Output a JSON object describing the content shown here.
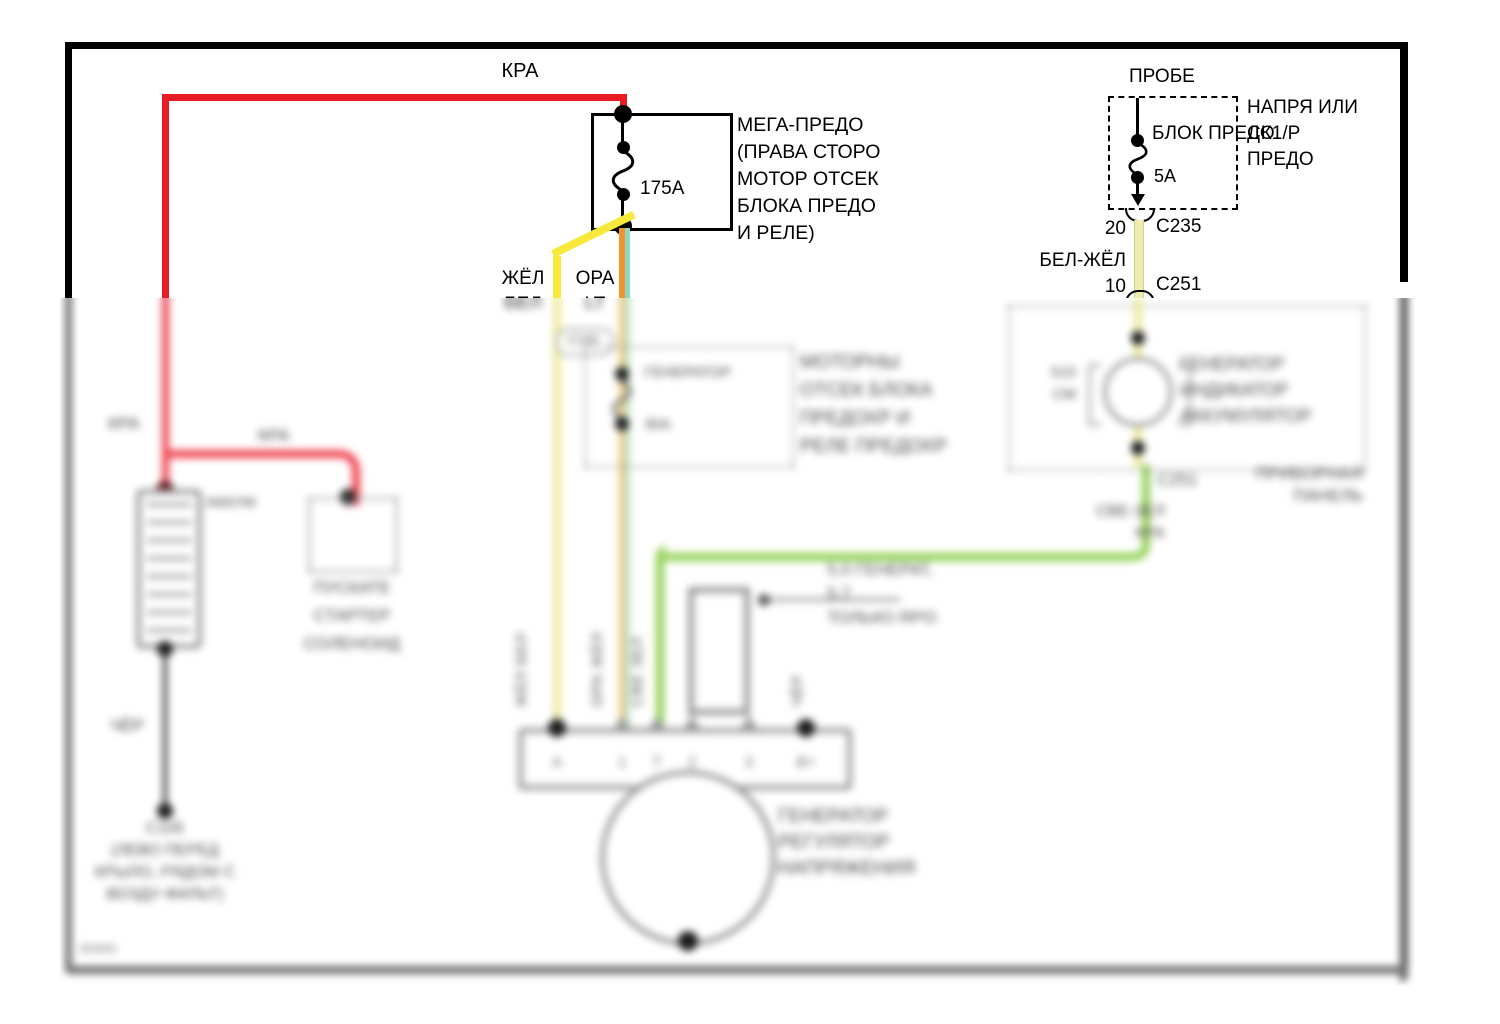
{
  "colors": {
    "wire_red": "#e81c24",
    "wire_yellow": "#f6e93c",
    "wire_pale_yellow": "#efedae",
    "wire_orange": "#f2932b",
    "wire_teal": "#8fd6c9",
    "wire_green": "#93d155",
    "wire_black": "#1a1a1a",
    "component_gray": "#9a9a9a",
    "frame_black": "#000000",
    "panel_border_gray": "#6f6f6f"
  },
  "top_section": {
    "kra_wire_label": "КРА",
    "mega_fuse": {
      "amp_label": "175А",
      "desc_lines": [
        "МЕГА-ПРЕДО",
        "(ПРАВА СТОРО",
        "МОТОР ОТСЕК",
        "БЛОКА ПРЕДО",
        "И РЕЛЕ)"
      ]
    },
    "yellow_wire_label_lines": [
      "ЖЁЛ",
      "БЕЛ"
    ],
    "orange_wire_label_lines": [
      "ОРА",
      "LT"
    ],
    "probe_fuse": {
      "title": "ПРОБЕ",
      "box_label": "БЛОК ПРЕДО",
      "amp_label": "5А",
      "side_note_lines": [
        "НАПРЯ ИЛИ",
        "СК1/Р",
        "ПРЕДО"
      ]
    },
    "connector_c235": {
      "pin": "20",
      "name": "С235"
    },
    "wire_bel_zhel_label": "БЕЛ-ЖЁЛ",
    "connector_c251": {
      "pin": "10",
      "name": "С251"
    }
  },
  "blurred_section": {
    "left": {
      "kra_label_1": "КРА",
      "kra_label_2": "КРА",
      "battery_label": "АККУМ",
      "solenoid_lines": [
        "ПУСКАТЕ",
        "СТАРТЕР",
        "СОЛЕНОИД"
      ],
      "cher_label": "ЧЁР",
      "ground_lines": [
        "С105",
        "(ЛЕВО ПЕРЕД",
        "КРЫЛО, РЯДОМ С",
        "ВОЗДУ-ФИЛЬТ)"
      ],
      "corner_code": "60000"
    },
    "middle": {
      "c100_label": "С100",
      "fuse_name": "ГЕНЕРАТОР",
      "fuse_amp": "30А",
      "fuse_note_lines": [
        "МОТОРНЫ",
        "ОТСЕК БЛОКА",
        "ПРЕДОХР И",
        "РЕЛЕ ПРЕДОХР"
      ],
      "loop_note_lines": [
        "5.0 ГЕНЕРАТ,",
        "5.7",
        "ТОЛЬКО RPO"
      ],
      "wire_labels": [
        "ЖЁЛ БЕЛ",
        "ОРА ЖЁЛ",
        "СВЕ ЗЕЛ",
        "ЧЁР"
      ],
      "cut_label_bel": "БЕЛ",
      "cut_label_lt": "LT",
      "terminals": [
        "А",
        "1",
        "Т",
        "2",
        "3",
        "В+"
      ],
      "generator_lines": [
        "ГЕНЕРАТОР",
        "РЕГУЛЯТОР",
        "НАПРЯЖЕНИЯ"
      ]
    },
    "right": {
      "lamp_left_lines": [
        "515",
        "СМ"
      ],
      "lamp_right_lines": [
        "ГЕНЕРАТОР",
        "ИНДИКАТОР",
        "АККУМУЛЯТОР"
      ],
      "connector": "С251",
      "panel_lines": [
        "ПРИБОРНАЯ",
        "ПАНЕЛЬ"
      ],
      "green_wire_lines": [
        "СВЕ-ЗЕЛ",
        "КРА"
      ]
    }
  }
}
